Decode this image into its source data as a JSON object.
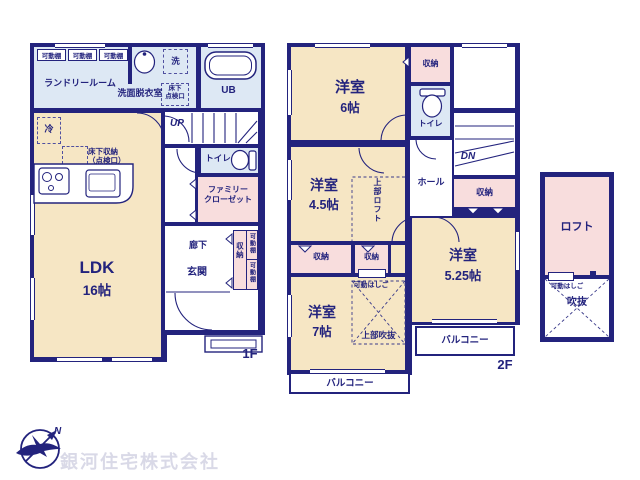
{
  "colors": {
    "wall": "#23237d",
    "room_cream": "#f6e6c4",
    "room_blue": "#dde8f4",
    "room_pink": "#f8dddd",
    "logo_text": "#d9d9e7"
  },
  "f1": {
    "floor_label": "1F",
    "laundry": "ランドリールーム",
    "laundry_shelves": [
      "可動棚",
      "可動棚",
      "可動棚"
    ],
    "washroom": "洗面脱衣室",
    "washer": "洗",
    "hatch": [
      "床下",
      "点検口"
    ],
    "bath": "UB",
    "fridge": "冷",
    "floor_storage": [
      "床下収納",
      "（点検口）"
    ],
    "stairs": "UP",
    "toilet": "トイレ",
    "family_closet": [
      "ファミリー",
      "クローゼット"
    ],
    "hallway": "廊下",
    "entrance": "玄関",
    "closet": "収納",
    "closet_shelves": [
      "可動棚",
      "可動棚"
    ],
    "ldk": "LDK",
    "ldk_size": "16帖"
  },
  "f2": {
    "floor_label": "2F",
    "room6": "洋室",
    "room6_size": "6帖",
    "closet_top": "収納",
    "toilet": "トイレ",
    "stairs": "DN",
    "hall": "ホール",
    "closet_stairs": "収納",
    "room45": "洋室",
    "room45_size": "4.5帖",
    "loft_above": "上部ロフト",
    "closet_a": "収納",
    "closet_b": "収納",
    "ladder": "可動はしご",
    "room7": "洋室",
    "room7_size": "7帖",
    "void_above": "上部吹抜",
    "room525": "洋室",
    "room525_size": "5.25帖",
    "balcony_right": "バルコニー",
    "balcony_bottom": "バルコニー"
  },
  "loft": {
    "name": "ロフト",
    "ladder": "可動はしご",
    "void": "吹抜"
  },
  "logo": {
    "company": "銀河住宅株式会社",
    "north": "N"
  }
}
